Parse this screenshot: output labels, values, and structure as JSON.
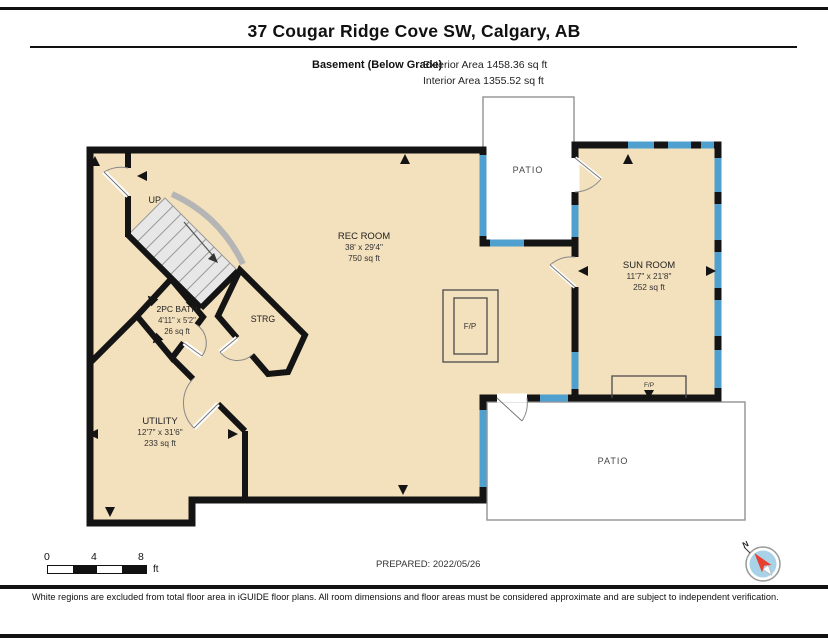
{
  "header": {
    "title": "37 Cougar Ridge Cove SW, Calgary, AB",
    "floor_label": "Basement (Below Grade)",
    "exterior_area": "Exterior Area 1458.36 sq ft",
    "interior_area": "Interior Area 1355.52 sq ft"
  },
  "plan": {
    "rooms": {
      "rec_room": {
        "name": "REC ROOM",
        "dims": "38' x 29'4\"",
        "area": "750 sq ft"
      },
      "sun_room": {
        "name": "SUN ROOM",
        "dims": "11'7\" x 21'8\"",
        "area": "252 sq ft"
      },
      "utility": {
        "name": "UTILITY",
        "dims": "12'7\" x 31'6\"",
        "area": "233 sq ft"
      },
      "bath": {
        "name": "2PC BATH",
        "dims": "4'11\" x 5'2\"",
        "area": "26 sq ft"
      },
      "storage": {
        "name": "STRG"
      },
      "patio_top": {
        "name": "PATIO"
      },
      "patio_bottom": {
        "name": "PATIO"
      },
      "fireplace_main": {
        "label": "F/P"
      },
      "fireplace_sun": {
        "label": "F/P"
      },
      "stairs": {
        "label": "UP"
      }
    },
    "compass": {
      "north_label": "N"
    }
  },
  "scale_bar": {
    "ticks": [
      "0",
      "4",
      "8"
    ],
    "unit": "ft"
  },
  "footer": {
    "prepared": "PREPARED: 2022/05/26",
    "disclaimer": "White regions are excluded from total floor area in iGUIDE floor plans. All room dimensions and floor areas must be considered approximate and are subject to independent verification."
  },
  "colors": {
    "floor_fill": "#F3E0BC",
    "wall": "#141414",
    "window": "#4FA0CE",
    "patio_fill": "#FFFFFF",
    "patio_border": "#999999",
    "stair_fill": "#E7E7E7",
    "compass_face": "#A8D2E8",
    "compass_needle": "#E8402F"
  }
}
